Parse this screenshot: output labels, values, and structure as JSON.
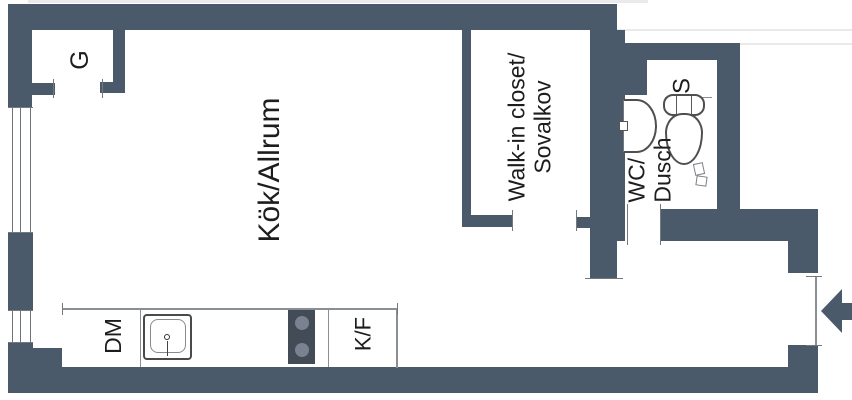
{
  "plan": {
    "title": "Studio apartment floor plan",
    "rooms": [
      {
        "id": "kitchen_living",
        "label": "Kök/Allrum"
      },
      {
        "id": "walk_in_closet",
        "line1": "Walk-in closet/",
        "line2": "Sovalkov"
      },
      {
        "id": "wc_shower",
        "line1": "WC/",
        "line2": "Dusch"
      },
      {
        "id": "wardrobe",
        "label": "G"
      },
      {
        "id": "cabinet",
        "label": "S"
      }
    ],
    "appliances": [
      {
        "id": "dishwasher",
        "label": "DM"
      },
      {
        "id": "fridge_freezer",
        "label": "K/F"
      }
    ],
    "symbols": [
      {
        "id": "entrance-arrow",
        "description": "left-pointing entry arrow at door opening in right wall"
      },
      {
        "id": "stove",
        "burners": 2
      },
      {
        "id": "kitchen-sink",
        "description": "counter sink with faucet"
      },
      {
        "id": "washbasin",
        "description": "half-round basin in WC"
      },
      {
        "id": "toilet",
        "description": "toilet with tank in WC"
      },
      {
        "id": "window",
        "count": 2,
        "location": "left wall"
      }
    ],
    "colors": {
      "wall": "#4b5a6b",
      "stove": "#434b57",
      "burner": "#7a8190",
      "line": "#8a8f96",
      "text": "#1d1d1f",
      "background": "#ffffff"
    }
  }
}
